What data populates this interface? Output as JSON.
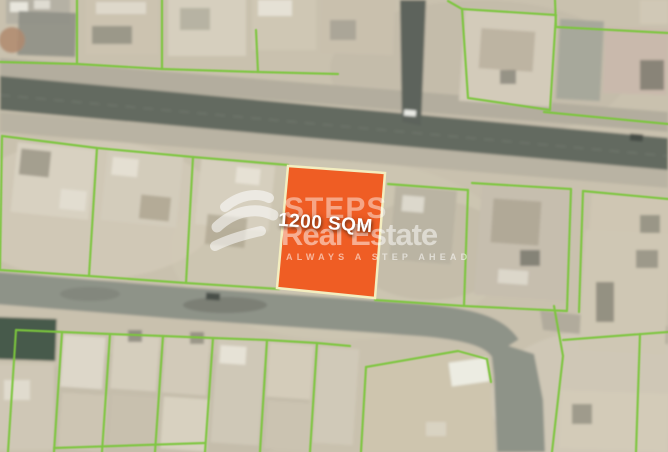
{
  "listing": {
    "area_label": "1200 SQM",
    "plot_fill": "#EF5D24",
    "plot_border": "#F3EEC0"
  },
  "brand": {
    "logo_icon": "steps-swoosh",
    "name_line1": "STEPS",
    "name_line2": "Real Estate",
    "tagline": "ALWAYS A STEP AHEAD"
  },
  "map": {
    "imagery": "satellite",
    "ground_color": "#C9C1AE",
    "road_color": "#636A61",
    "secondary_road_color": "#8E9388",
    "parcel_line_color": "#7CC63E"
  }
}
